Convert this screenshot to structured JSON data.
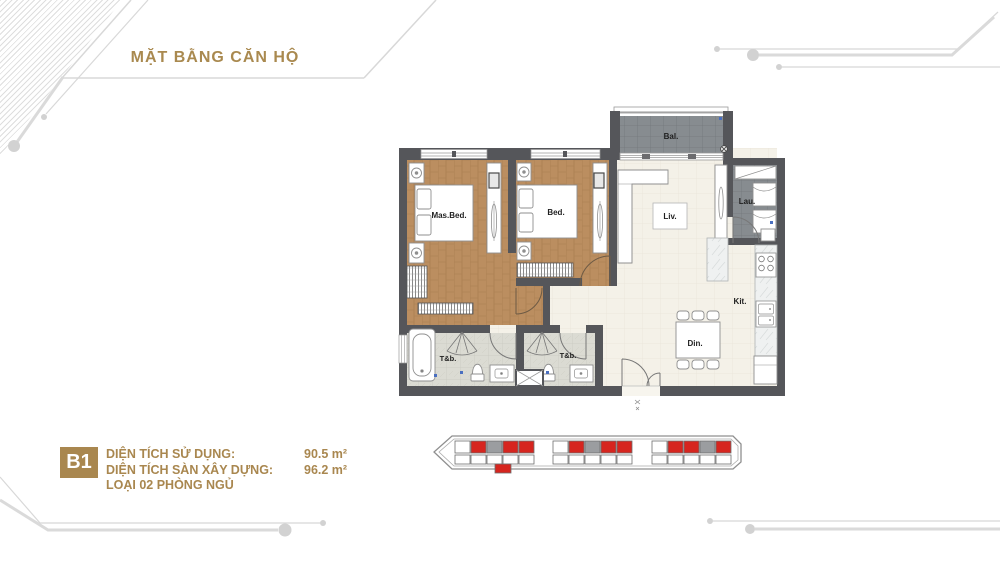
{
  "title": "MẶT BẰNG CĂN HỘ",
  "unit": {
    "code": "B1",
    "rows": [
      {
        "label": "DIỆN TÍCH SỬ DỤNG:",
        "value": "90.5 m²"
      },
      {
        "label": "DIỆN TÍCH SÀN XÂY DỰNG:",
        "value": "96.2 m²"
      }
    ],
    "type_line": "LOẠI 02 PHÒNG NGỦ"
  },
  "floorplan": {
    "rooms": {
      "balcony": "Bal.",
      "master_bedroom": "Mas.Bed.",
      "bedroom": "Bed.",
      "living": "Liv.",
      "laundry": "Lau.",
      "kitchen": "Kit.",
      "dining": "Din.",
      "bathroom1": "T&b.",
      "bathroom2": "T&b."
    }
  },
  "key_plan": {
    "colors": {
      "red": "#d6251f",
      "gray": "#9b9da0",
      "white": "#ffffff"
    },
    "clusters": [
      {
        "top": [
          "white",
          "red",
          "gray",
          "red",
          "red"
        ],
        "bottom": [
          "white",
          "white",
          "white",
          "white",
          "white"
        ],
        "below": "red"
      },
      {
        "top": [
          "white",
          "red",
          "gray",
          "red",
          "red"
        ],
        "bottom": [
          "white",
          "white",
          "white",
          "white",
          "white"
        ],
        "below": null
      },
      {
        "top": [
          "white",
          "red",
          "red",
          "gray",
          "red"
        ],
        "bottom": [
          "white",
          "white",
          "white",
          "white",
          "white"
        ],
        "below": null
      }
    ]
  },
  "colors": {
    "gold": "#a9874f",
    "wall": "#55565a",
    "wood_floor": "#bb8e60",
    "highlight_red": "#d6251f",
    "tile_dark": "#878c90",
    "tile_bath": "#dbdbd3",
    "floor_cream": "#f4f1e8",
    "decor_line": "#d9d9d9",
    "marker_blue": "#4a6fc0"
  }
}
